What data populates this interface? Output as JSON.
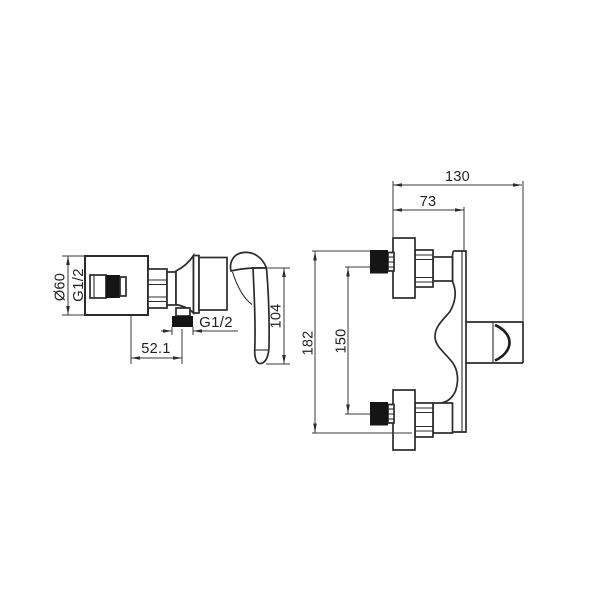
{
  "drawing": {
    "background": "#ffffff",
    "line_color": "#2b2b2b",
    "fill_color": "#151515",
    "views": {
      "side_view": {
        "name": "shower-mixer-side-view",
        "labels": {
          "escutcheon_diameter": "Ø60",
          "inlet_thread": "G1/2",
          "outlet_thread": "G1/2",
          "outlet_offset": "52.1",
          "handle_length": "104"
        }
      },
      "front_view": {
        "name": "shower-mixer-front-view",
        "labels": {
          "overall_depth": "130",
          "valve_body_depth": "73",
          "overall_height": "182",
          "inlet_spacing": "150"
        }
      }
    }
  }
}
